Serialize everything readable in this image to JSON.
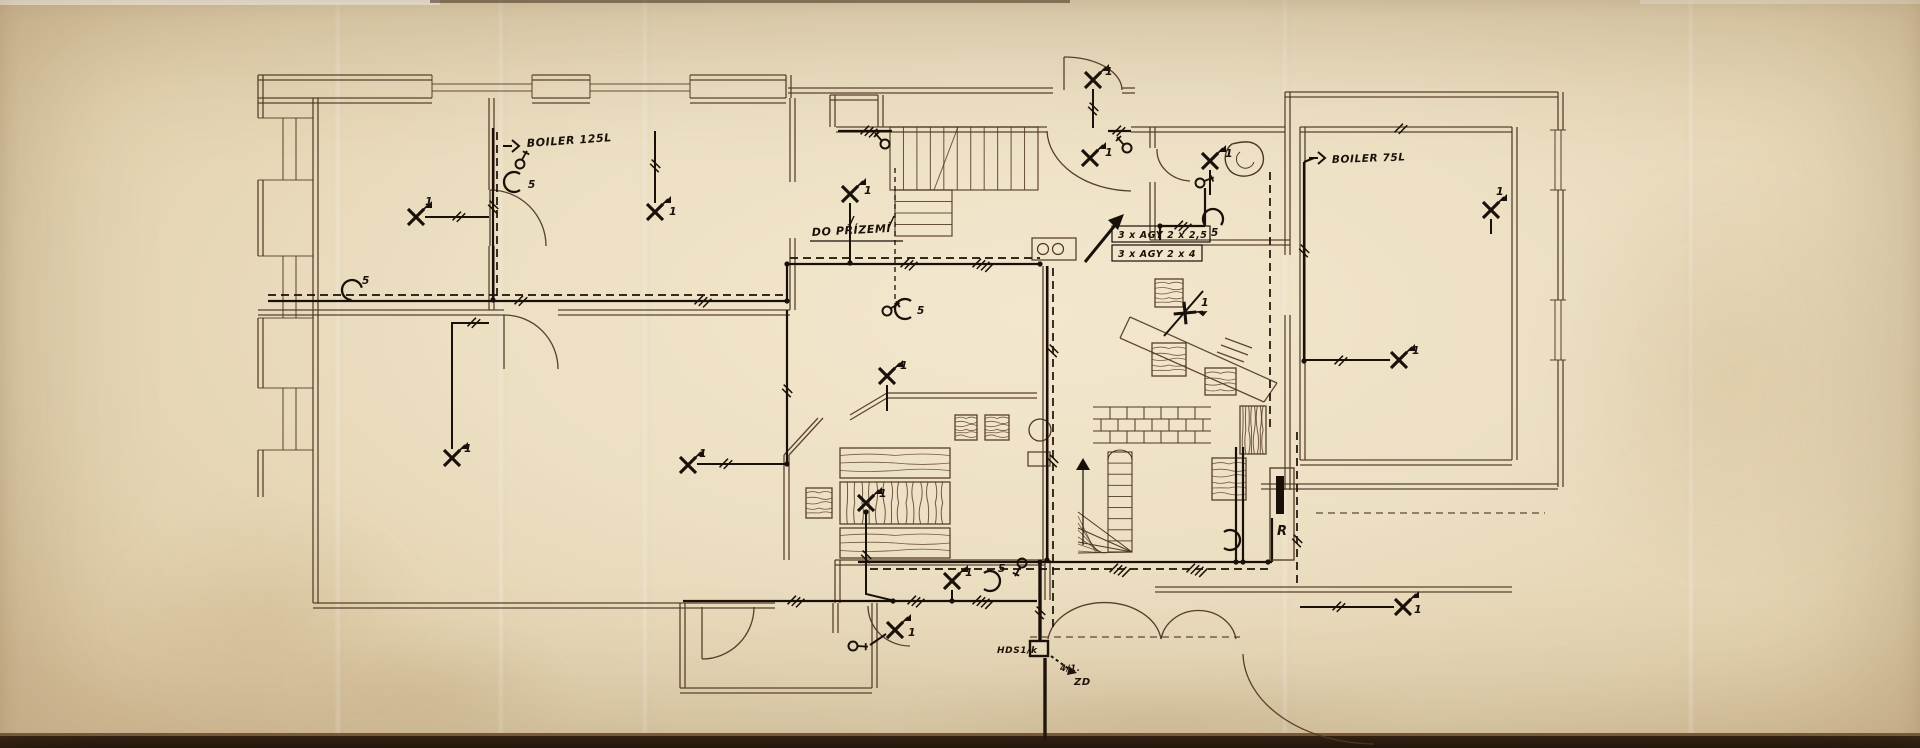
{
  "document": {
    "kind": "hand-drawn electrical installation floor plan (photographed aged tracing paper)",
    "language": "Czech"
  },
  "colors": {
    "paper": "#ecdfc2",
    "plan_ink": "#4e3624",
    "electrical_ink": "#191009",
    "photo_edge": "#1b110b"
  },
  "texts": [
    {
      "id": "label-boiler-125l",
      "str": "BOILER 125L",
      "x": 527,
      "y": 147,
      "s": 11,
      "rot": -4
    },
    {
      "id": "label-do-prizemi",
      "str": "DO PŘÍZEMÍ",
      "x": 812,
      "y": 236,
      "s": 11,
      "rot": -3,
      "ul": 92
    },
    {
      "id": "label-cable-agy-25",
      "str": "3 x AGY 2 x 2,5",
      "x": 1118,
      "y": 238,
      "s": 9.5,
      "rot": 0
    },
    {
      "id": "label-cable-agy-4",
      "str": "3 x AGY 2 x 4",
      "x": 1118,
      "y": 257,
      "s": 9.5,
      "rot": 0
    },
    {
      "id": "label-boiler-75l",
      "str": "BOILER 75L",
      "x": 1332,
      "y": 163,
      "s": 10.5,
      "rot": -2
    },
    {
      "id": "label-distribution-board",
      "str": "R",
      "x": 1277,
      "y": 535,
      "s": 13,
      "rot": 0
    },
    {
      "id": "label-hds",
      "str": "HDS1/k",
      "x": 997,
      "y": 653,
      "s": 9,
      "rot": 0
    },
    {
      "id": "label-fraction",
      "str": "4/1.",
      "x": 1060,
      "y": 671,
      "s": 8.5,
      "rot": 0
    },
    {
      "id": "label-zd",
      "str": "ZD",
      "x": 1074,
      "y": 685,
      "s": 10,
      "rot": 0
    }
  ],
  "lights": [
    {
      "x": 416,
      "y": 217,
      "rot": 0,
      "label": "1",
      "ldx": 9,
      "ldy": -12,
      "wire": [
        [
          425,
          217
        ],
        [
          489,
          217
        ]
      ]
    },
    {
      "x": 655,
      "y": 212,
      "rot": 0,
      "label": "1",
      "ldx": 14,
      "ldy": 3,
      "wire": [
        [
          655,
          203
        ],
        [
          655,
          131
        ]
      ]
    },
    {
      "x": 850,
      "y": 194,
      "rot": 0,
      "label": "1",
      "ldx": 14,
      "ldy": 0,
      "wire": [
        [
          850,
          203
        ],
        [
          850,
          261
        ]
      ]
    },
    {
      "x": 1093,
      "y": 80,
      "rot": 0,
      "label": "1",
      "ldx": 12,
      "ldy": -5,
      "wire": [
        [
          1093,
          89
        ],
        [
          1093,
          128
        ]
      ]
    },
    {
      "x": 1090,
      "y": 158,
      "rot": 0,
      "label": "1",
      "ldx": 15,
      "ldy": -2,
      "wire": []
    },
    {
      "x": 1210,
      "y": 161,
      "rot": 0,
      "label": "1",
      "ldx": 15,
      "ldy": -4,
      "wire": [
        [
          1210,
          170
        ],
        [
          1210,
          195
        ]
      ]
    },
    {
      "x": 1399,
      "y": 360,
      "rot": 0,
      "label": "1",
      "ldx": 13,
      "ldy": -6,
      "wire": [
        [
          1390,
          360
        ],
        [
          1304,
          360
        ]
      ]
    },
    {
      "x": 1491,
      "y": 210,
      "rot": 0,
      "label": "1",
      "ldx": 5,
      "ldy": -15,
      "wire": [
        [
          1491,
          219
        ],
        [
          1491,
          234
        ]
      ]
    },
    {
      "x": 1185,
      "y": 313,
      "rot": 40,
      "label": "1",
      "ldx": 16,
      "ldy": -7,
      "wire": [
        [
          1164,
          336
        ],
        [
          1203,
          291
        ]
      ]
    },
    {
      "x": 887,
      "y": 376,
      "rot": 0,
      "label": "1",
      "ldx": 13,
      "ldy": -7,
      "wire": [
        [
          887,
          385
        ],
        [
          887,
          411
        ]
      ]
    },
    {
      "x": 866,
      "y": 503,
      "rot": 0,
      "label": "1",
      "ldx": 13,
      "ldy": -6,
      "wire": [
        [
          866,
          512
        ],
        [
          866,
          594
        ],
        [
          891,
          600
        ]
      ]
    },
    {
      "x": 952,
      "y": 581,
      "rot": 0,
      "label": "1",
      "ldx": 13,
      "ldy": -5,
      "wire": [
        [
          952,
          590
        ],
        [
          952,
          600
        ]
      ]
    },
    {
      "x": 895,
      "y": 630,
      "rot": 0,
      "label": "1",
      "ldx": 13,
      "ldy": 6,
      "wire": [
        [
          886,
          634
        ],
        [
          870,
          645
        ]
      ]
    },
    {
      "x": 1403,
      "y": 607,
      "rot": 0,
      "label": "1",
      "ldx": 11,
      "ldy": 6,
      "wire": [
        [
          1394,
          607
        ],
        [
          1300,
          607
        ]
      ]
    },
    {
      "x": 452,
      "y": 458,
      "rot": 0,
      "label": "1",
      "ldx": 12,
      "ldy": -6,
      "wire": [
        [
          452,
          449
        ],
        [
          452,
          323
        ],
        [
          489,
          323
        ]
      ]
    },
    {
      "x": 688,
      "y": 465,
      "rot": 0,
      "label": "1",
      "ldx": 11,
      "ldy": -8,
      "wire": [
        [
          697,
          464
        ],
        [
          787,
          464
        ]
      ]
    }
  ],
  "lamps": [
    {
      "x": 514,
      "y": 182,
      "rot": 0,
      "label": "5",
      "ldx": 14,
      "ldy": 6
    },
    {
      "x": 352,
      "y": 290,
      "rot": 40,
      "label": "5",
      "ldx": 10,
      "ldy": -6
    },
    {
      "x": 905,
      "y": 309,
      "rot": 0,
      "label": "5",
      "ldx": 12,
      "ldy": 5
    },
    {
      "x": 990,
      "y": 581,
      "rot": 180,
      "label": "5",
      "ldx": 8,
      "ldy": -9
    },
    {
      "x": 1230,
      "y": 540,
      "rot": 180,
      "label": "",
      "ldx": 0,
      "ldy": 0
    },
    {
      "x": 1213,
      "y": 219,
      "rot": 90,
      "label": "5",
      "ldx": -2,
      "ldy": 17
    }
  ],
  "switches": [
    {
      "x": 520,
      "y": 164,
      "rot": -20
    },
    {
      "x": 887,
      "y": 311,
      "rot": 10
    },
    {
      "x": 885,
      "y": 144,
      "rot": -90
    },
    {
      "x": 1127,
      "y": 148,
      "rot": -90
    },
    {
      "x": 1200,
      "y": 183,
      "rot": 20
    },
    {
      "x": 1022,
      "y": 563,
      "rot": 160
    },
    {
      "x": 853,
      "y": 646,
      "rot": 45
    }
  ],
  "wall_lights": [
    {
      "x": 512,
      "y": 146,
      "rot": 0
    },
    {
      "x": 1318,
      "y": 158,
      "rot": 0
    }
  ],
  "hatches": [
    [
      520,
      301,
      20,
      2
    ],
    [
      700,
      301,
      20,
      3
    ],
    [
      906,
      264,
      20,
      3
    ],
    [
      978,
      264,
      20,
      4
    ],
    [
      725,
      464,
      20,
      2
    ],
    [
      473,
      323,
      20,
      2
    ],
    [
      1115,
      569,
      20,
      4
    ],
    [
      1192,
      569,
      20,
      4
    ],
    [
      913,
      601,
      20,
      3
    ],
    [
      978,
      601,
      20,
      4
    ],
    [
      793,
      601,
      20,
      3
    ],
    [
      866,
      131,
      20,
      3
    ],
    [
      1118,
      131,
      20,
      2
    ],
    [
      1400,
      129,
      20,
      2
    ],
    [
      1340,
      361,
      20,
      2
    ],
    [
      1180,
      226,
      20,
      3
    ],
    [
      1338,
      607,
      20,
      2
    ],
    [
      458,
      217,
      20,
      2
    ],
    [
      493,
      206,
      110,
      2
    ],
    [
      1053,
      350,
      110,
      2
    ],
    [
      1053,
      460,
      110,
      2
    ],
    [
      866,
      556,
      110,
      2
    ],
    [
      655,
      165,
      110,
      2
    ],
    [
      1297,
      540,
      110,
      2
    ],
    [
      1304,
      250,
      110,
      2
    ],
    [
      787,
      390,
      110,
      2
    ],
    [
      1040,
      612,
      110,
      2
    ],
    [
      1093,
      108,
      110,
      2
    ]
  ],
  "dots": [
    [
      787,
      301
    ],
    [
      787,
      264
    ],
    [
      787,
      464
    ],
    [
      850,
      263
    ],
    [
      893,
      601
    ],
    [
      952,
      601
    ],
    [
      1040,
      264
    ],
    [
      1040,
      562
    ],
    [
      1047,
      560
    ],
    [
      866,
      512
    ],
    [
      1236,
      562
    ],
    [
      1243,
      562
    ],
    [
      1268,
      562
    ],
    [
      1160,
      226
    ],
    [
      1304,
      361
    ],
    [
      493,
      300
    ]
  ]
}
